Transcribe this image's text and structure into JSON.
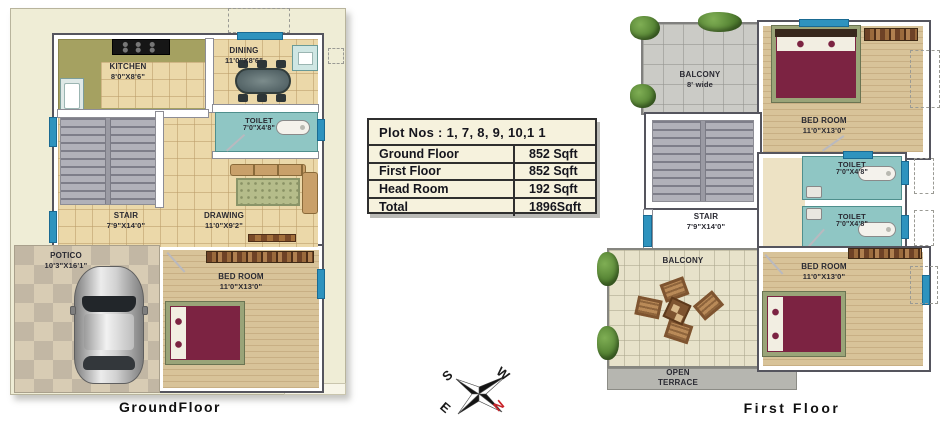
{
  "area_table": {
    "title": "Plot  Nos : 1, 7, 8, 9, 10,1 1",
    "rows": [
      {
        "label": "Ground Floor",
        "value": "852 Sqft"
      },
      {
        "label": "First Floor",
        "value": "852 Sqft"
      },
      {
        "label": "Head Room",
        "value": "192 Sqft"
      },
      {
        "label": "Total",
        "value": "1896Sqft"
      }
    ]
  },
  "ground_floor": {
    "caption": "GroundFloor",
    "kitchen": {
      "name": "KITCHEN",
      "dims": "8'0\"X8'6\""
    },
    "dining": {
      "name": "DINING",
      "dims": "11'0\"X8'6\""
    },
    "toilet": {
      "name": "TOILET",
      "dims": "7'0\"X4'8\""
    },
    "stair": {
      "name": "STAIR",
      "dims": "7'9\"X14'0\""
    },
    "drawing": {
      "name": "DRAWING",
      "dims": "11'0\"X9'2\""
    },
    "portico": {
      "name": "POTICO",
      "dims": "10'3\"X16'1\""
    },
    "bedroom": {
      "name": "BED ROOM",
      "dims": "11'0\"X13'0\""
    }
  },
  "first_floor": {
    "caption": "First Floor",
    "balcony_top": {
      "name": "BALCONY",
      "dims": "8' wide"
    },
    "bedroom_top": {
      "name": "BED ROOM",
      "dims": "11'0\"X13'0\""
    },
    "stair": {
      "name": "STAIR",
      "dims": "7'9\"X14'0\""
    },
    "toilet_upper": {
      "name": "TOILET",
      "dims": "7'0\"X4'8\""
    },
    "toilet_lower": {
      "name": "TOILET",
      "dims": "7'0\"X4'8\""
    },
    "balcony_bottom": {
      "name": "BALCONY"
    },
    "open_terrace": {
      "name": "OPEN TERRACE"
    },
    "bedroom_bottom": {
      "name": "BED ROOM",
      "dims": "11'0\"X13'0\""
    }
  },
  "compass": {
    "north": "N",
    "south": "S",
    "east": "E",
    "west": "W"
  },
  "colors": {
    "plot_background": "#EFEDD6",
    "floor_tile": "#EBD8A9",
    "kitchen_olive": "#A5A161",
    "toilet_teal": "#8FC6C4",
    "stair_gray": "#B1B1B9",
    "wood_floor": "#D8C399",
    "bed_maroon": "#7C2342",
    "window_blue": "#2E93BE",
    "balcony_stone": "#CBCBC6",
    "terrace_gray": "#B6B6B0",
    "table_cream": "#F6F2DD",
    "compass_north_red": "#C8242A"
  }
}
